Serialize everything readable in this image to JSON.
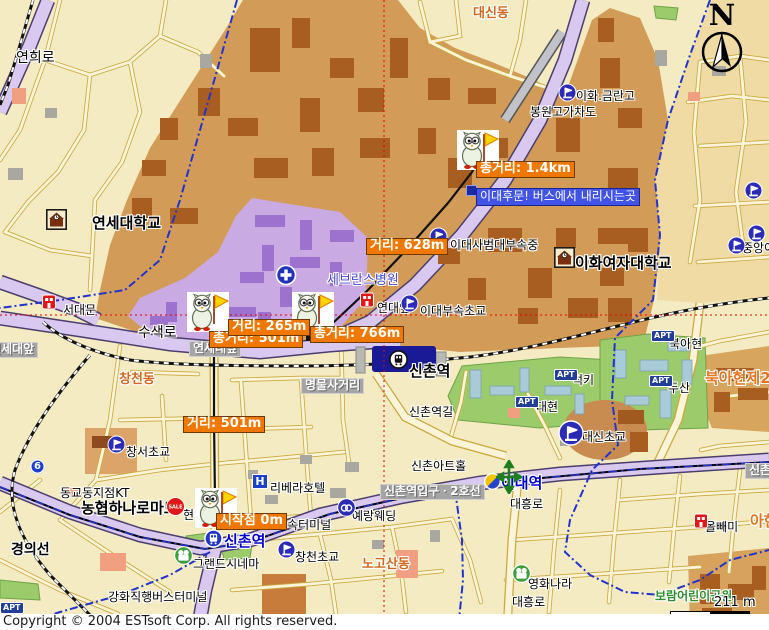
{
  "copyright": "Copyright © 2004 ESTsoft Corp. All rights reserved.",
  "compass": {
    "label": "N"
  },
  "scale": {
    "text": "211 m"
  },
  "colors": {
    "background": "#F4EBC2",
    "mountain_tan": "#D29C58",
    "campus_purple": "#C9AAE3",
    "road_purple": "#D9C8F0",
    "distance_tag": "#F07800",
    "info_tag": "#4253E8",
    "station_navy": "#1A1A96",
    "crosshair_red": "#E80000",
    "boundary_blue": "#2233CC",
    "park_green": "#9CCB6B"
  },
  "labels": [
    {
      "name": "road-yeonhui",
      "kind": "road14",
      "x": 16,
      "y": 50,
      "text": "연희로"
    },
    {
      "name": "district-daesindong",
      "kind": "district",
      "x": 473,
      "y": 7,
      "text": "대신동"
    },
    {
      "name": "poi-ewha-geumran-high",
      "kind": "poi",
      "x": 576,
      "y": 90,
      "text": "이화.금란고"
    },
    {
      "name": "poi-bongwon-overpass",
      "kind": "poi",
      "x": 530,
      "y": 106,
      "text": "봉원고가차도"
    },
    {
      "name": "poi-yonsei-university",
      "kind": "big",
      "x": 92,
      "y": 215,
      "text": "연세대학교"
    },
    {
      "name": "poi-severance-hospital",
      "kind": "blue",
      "x": 327,
      "y": 274,
      "text": "세브란스병원"
    },
    {
      "name": "poi-edae-middle-school",
      "kind": "poi",
      "x": 450,
      "y": 239,
      "text": "이대사범대부속중"
    },
    {
      "name": "poi-ewha-university",
      "kind": "big",
      "x": 575,
      "y": 255,
      "text": "이화여자대학교"
    },
    {
      "name": "poi-edae-elementary",
      "kind": "poi",
      "x": 420,
      "y": 305,
      "text": "이대부속초교"
    },
    {
      "name": "poi-yondae-ap",
      "kind": "poi",
      "x": 377,
      "y": 302,
      "text": "연대앞"
    },
    {
      "name": "poi-seodaemun",
      "kind": "poi",
      "x": 63,
      "y": 304,
      "text": "서대문"
    },
    {
      "name": "road-susaek",
      "kind": "road14",
      "x": 138,
      "y": 325,
      "text": "수색로"
    },
    {
      "name": "busstop-yonsei-ap-left",
      "kind": "gray",
      "x": -14,
      "y": 342,
      "text": "연세대앞"
    },
    {
      "name": "busstop-yonsei-ap",
      "kind": "gray",
      "x": 189,
      "y": 341,
      "text": "연세대앞"
    },
    {
      "name": "district-changcheondong",
      "kind": "district",
      "x": 119,
      "y": 373,
      "text": "창천동"
    },
    {
      "name": "busstop-myeongmul",
      "kind": "gray",
      "x": 301,
      "y": 378,
      "text": "명물사거리"
    },
    {
      "name": "station-sinchon-rail",
      "kind": "rail",
      "x": 409,
      "y": 363,
      "text": "신촌역"
    },
    {
      "name": "road-sinchonyeok-gil",
      "kind": "road",
      "x": 409,
      "y": 406,
      "text": "신촌역길"
    },
    {
      "name": "poi-lucky-apt",
      "kind": "poi",
      "x": 572,
      "y": 374,
      "text": "럭키"
    },
    {
      "name": "poi-bukahyeon",
      "kind": "poi",
      "x": 669,
      "y": 338,
      "text": "북아현"
    },
    {
      "name": "poi-doosan-apt",
      "kind": "poi",
      "x": 668,
      "y": 382,
      "text": "두산"
    },
    {
      "name": "district-bukahyeon2",
      "kind": "districtbig",
      "x": 705,
      "y": 370,
      "text": "북아현제2동"
    },
    {
      "name": "poi-daehyeon",
      "kind": "poi",
      "x": 536,
      "y": 401,
      "text": "대현"
    },
    {
      "name": "poi-daesin-elementary",
      "kind": "poi",
      "x": 582,
      "y": 431,
      "text": "대신초교"
    },
    {
      "name": "poi-changseo-elementary",
      "kind": "poi",
      "x": 126,
      "y": 446,
      "text": "창서초교"
    },
    {
      "name": "poi-kt-branch",
      "kind": "poi",
      "x": 60,
      "y": 487,
      "text": "동교동지점KT"
    },
    {
      "name": "poi-hanaro-mart",
      "kind": "big",
      "x": 81,
      "y": 500,
      "text": "농협하나로마트"
    },
    {
      "name": "poi-hyundai",
      "kind": "poi",
      "x": 183,
      "y": 509,
      "text": "현대"
    },
    {
      "name": "poi-rivera-hotel",
      "kind": "poi",
      "x": 270,
      "y": 482,
      "text": "리베라호텔"
    },
    {
      "name": "poi-sinchon-arthall",
      "kind": "poi",
      "x": 411,
      "y": 460,
      "text": "신촌아트홀"
    },
    {
      "name": "busstop-sinchon-entrance-line2",
      "kind": "gray",
      "x": 380,
      "y": 484,
      "text": "신촌역입구ㆍ2호선"
    },
    {
      "name": "station-edae",
      "kind": "station",
      "x": 501,
      "y": 475,
      "text": "이대역"
    },
    {
      "name": "road-daeheung-1",
      "kind": "road",
      "x": 510,
      "y": 498,
      "text": "대흥로"
    },
    {
      "name": "poi-yerang-wedding",
      "kind": "poi",
      "x": 352,
      "y": 510,
      "text": "예랑웨딩"
    },
    {
      "name": "poi-express-terminal",
      "kind": "poi",
      "x": 276,
      "y": 519,
      "text": "고속터미널"
    },
    {
      "name": "station-sinchon-subway",
      "kind": "station",
      "x": 224,
      "y": 533,
      "text": "신촌역"
    },
    {
      "name": "poi-changcheon-elementary",
      "kind": "poi",
      "x": 295,
      "y": 551,
      "text": "창천초교"
    },
    {
      "name": "district-nogosandong",
      "kind": "district",
      "x": 362,
      "y": 558,
      "text": "노고산동"
    },
    {
      "name": "poi-grand-cinema",
      "kind": "poi",
      "x": 193,
      "y": 558,
      "text": "그랜드시네마"
    },
    {
      "name": "road-gyeongui-line",
      "kind": "roadbold",
      "x": 11,
      "y": 542,
      "text": "경의선"
    },
    {
      "name": "poi-ganghwa-bus-terminal",
      "kind": "poi",
      "x": 108,
      "y": 591,
      "text": "강화직행버스터미널"
    },
    {
      "name": "poi-movie-nara",
      "kind": "poi",
      "x": 528,
      "y": 578,
      "text": "영화나라"
    },
    {
      "name": "road-daeheung-2",
      "kind": "road",
      "x": 512,
      "y": 596,
      "text": "대흥로"
    },
    {
      "name": "poi-owl",
      "kind": "poi",
      "x": 705,
      "y": 521,
      "text": "올빼미"
    },
    {
      "name": "district-ahyeon",
      "kind": "districtbig",
      "x": 750,
      "y": 513,
      "text": "아현"
    },
    {
      "name": "park-boram-children",
      "kind": "green",
      "x": 655,
      "y": 590,
      "text": "보람어린이공원"
    },
    {
      "name": "poi-jungang-girls",
      "kind": "poi",
      "x": 742,
      "y": 242,
      "text": "중앙여"
    },
    {
      "name": "busstop-sinchon-right",
      "kind": "gray",
      "x": 745,
      "y": 463,
      "text": "신촌"
    },
    {
      "name": "apt-badge-bukahyeon",
      "kind": "apt",
      "x": 651,
      "y": 330,
      "text": "APT"
    },
    {
      "name": "apt-badge-doosan",
      "kind": "apt",
      "x": 649,
      "y": 375,
      "text": "APT"
    },
    {
      "name": "apt-badge-daehyeon",
      "kind": "apt",
      "x": 515,
      "y": 396,
      "text": "APT"
    },
    {
      "name": "apt-badge-lucky",
      "kind": "apt",
      "x": 554,
      "y": 369,
      "text": "APT"
    },
    {
      "name": "apt-badge-edge",
      "kind": "apt",
      "x": 0,
      "y": 602,
      "text": "APT"
    },
    {
      "name": "hotel-badge-rivera",
      "kind": "hotel",
      "x": 252,
      "y": 474,
      "text": "H"
    },
    {
      "name": "road-shield-6",
      "kind": "shield",
      "x": 30,
      "y": 459,
      "text": "6"
    }
  ],
  "tags": [
    {
      "name": "tag-total-1-4km",
      "kind": "orange",
      "x": 476,
      "y": 161,
      "text": "총거리: 1.4km"
    },
    {
      "name": "tag-edae-backgate-info",
      "kind": "info",
      "x": 476,
      "y": 188,
      "text": "이대후문! 버스에서 내리시는곳"
    },
    {
      "name": "tag-dist-628m",
      "kind": "orange",
      "x": 366,
      "y": 238,
      "text": "거리: 628m"
    },
    {
      "name": "tag-total-501m",
      "kind": "orange",
      "x": 209,
      "y": 331,
      "text": "총거리: 501m"
    },
    {
      "name": "tag-dist-265m",
      "kind": "orange",
      "x": 228,
      "y": 319,
      "text": "거리: 265m"
    },
    {
      "name": "tag-total-766m",
      "kind": "orange",
      "x": 310,
      "y": 326,
      "text": "총거리: 766m"
    },
    {
      "name": "tag-dist-501m",
      "kind": "orange",
      "x": 183,
      "y": 416,
      "text": "거리: 501m"
    },
    {
      "name": "tag-start-0m",
      "kind": "orange",
      "x": 216,
      "y": 513,
      "text": "시작점 0m"
    }
  ],
  "icons": [
    {
      "type": "mascot",
      "name": "route-mascot-destination",
      "x": 457,
      "y": 130
    },
    {
      "type": "mascot",
      "name": "route-mascot-waypoint-1",
      "x": 187,
      "y": 292
    },
    {
      "type": "mascot",
      "name": "route-mascot-waypoint-2",
      "x": 292,
      "y": 292
    },
    {
      "type": "mascot",
      "name": "route-mascot-start",
      "x": 195,
      "y": 488
    },
    {
      "type": "school",
      "name": "school-icon-geumran",
      "x": 558,
      "y": 83
    },
    {
      "type": "school",
      "name": "school-icon-edae-middle",
      "x": 429,
      "y": 227
    },
    {
      "type": "school",
      "name": "school-icon-edae-elem",
      "x": 400,
      "y": 294
    },
    {
      "type": "school",
      "name": "school-icon-changseo",
      "x": 107,
      "y": 435
    },
    {
      "type": "school",
      "name": "school-icon-changcheon",
      "x": 277,
      "y": 540
    },
    {
      "type": "school",
      "name": "school-icon-jungang-1",
      "x": 727,
      "y": 236
    },
    {
      "type": "school",
      "name": "school-icon-jungang-2",
      "x": 744,
      "y": 181
    },
    {
      "type": "school",
      "name": "school-icon-jungang-3",
      "x": 747,
      "y": 224
    },
    {
      "type": "school_big",
      "name": "school-icon-daesin",
      "x": 558,
      "y": 420
    },
    {
      "type": "univ",
      "name": "university-icon-yonsei",
      "x": 46,
      "y": 209
    },
    {
      "type": "univ",
      "name": "university-icon-ewha",
      "x": 554,
      "y": 247
    },
    {
      "type": "hospital",
      "name": "hospital-icon-severance",
      "x": 275,
      "y": 264
    },
    {
      "type": "red",
      "name": "landmark-icon-yondae-ap",
      "x": 360,
      "y": 292
    },
    {
      "type": "red",
      "name": "landmark-icon-seodaemun",
      "x": 42,
      "y": 294
    },
    {
      "type": "red",
      "name": "landmark-icon-owl",
      "x": 694,
      "y": 513
    },
    {
      "type": "sale",
      "name": "sale-icon-hanaro",
      "x": 166,
      "y": 497
    },
    {
      "type": "movie",
      "name": "cinema-icon-grand",
      "x": 174,
      "y": 546
    },
    {
      "type": "movie",
      "name": "cinema-icon-movienara",
      "x": 512,
      "y": 564
    },
    {
      "type": "wedding",
      "name": "wedding-icon-yerang",
      "x": 337,
      "y": 498
    },
    {
      "type": "train",
      "name": "train-icon-sinchon-rail",
      "x": 389,
      "y": 350
    },
    {
      "type": "subway",
      "name": "subway-icon-sinchon",
      "x": 204,
      "y": 529
    },
    {
      "type": "line2",
      "name": "line2-icon-edae",
      "x": 484,
      "y": 473
    },
    {
      "type": "arrows",
      "name": "interchange-icon-edae",
      "x": 496,
      "y": 460
    },
    {
      "type": "marker",
      "name": "route-end-marker",
      "x": 466,
      "y": 181
    },
    {
      "type": "tick",
      "name": "route-tick-1",
      "x": 225,
      "y": 324
    },
    {
      "type": "tick",
      "name": "route-tick-2",
      "x": 306,
      "y": 326
    }
  ]
}
